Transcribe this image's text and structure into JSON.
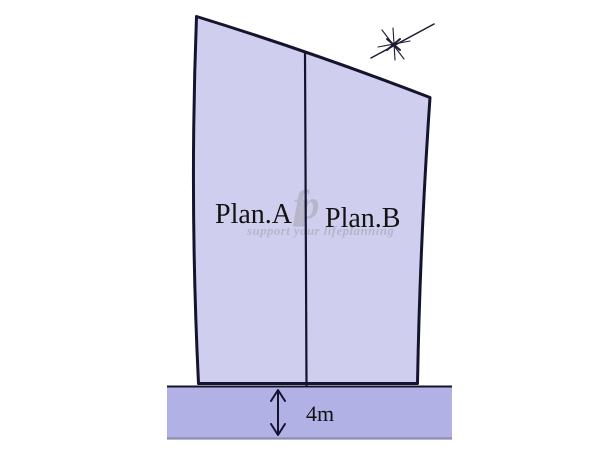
{
  "diagram": {
    "type": "land-plot-division",
    "plots": [
      {
        "label": "Plan.A"
      },
      {
        "label": "Plan.B"
      }
    ],
    "road": {
      "width_label": "4m"
    },
    "watermark": {
      "logo": "fp",
      "tagline": "support your lifeplanning"
    },
    "icons": {
      "compass": "north-compass-sketch",
      "road_width_arrow": "double-headed-vertical-arrow"
    },
    "colors": {
      "plot_fill": "#cfceef",
      "road_fill": "#b2b1e6",
      "outline": "#15142e",
      "divider": "#15142e",
      "road_edge": "#8e8db0",
      "label_text": "#131313",
      "watermark": "#b6b5c9",
      "background": "#ffffff"
    }
  }
}
